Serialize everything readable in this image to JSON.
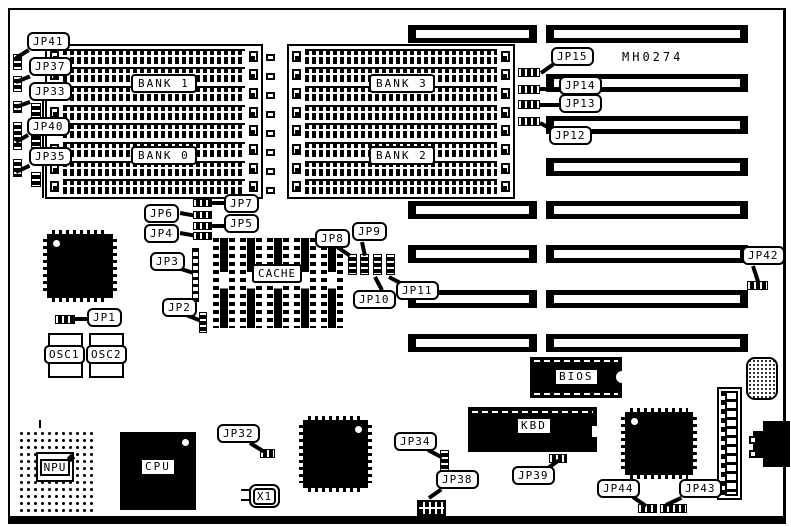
{
  "board": {
    "code": "MH0274"
  },
  "banks": {
    "bank0": "BANK 0",
    "bank1": "BANK 1",
    "bank2": "BANK 2",
    "bank3": "BANK 3"
  },
  "chips": {
    "cache": "CACHE",
    "bios": "BIOS",
    "kbd": "KBD",
    "npu": "NPU",
    "cpu": "CPU",
    "osc1": "OSC1",
    "osc2": "OSC2",
    "x1": "X1"
  },
  "jumpers": {
    "jp1": "JP1",
    "jp2": "JP2",
    "jp3": "JP3",
    "jp4": "JP4",
    "jp5": "JP5",
    "jp6": "JP6",
    "jp7": "JP7",
    "jp8": "JP8",
    "jp9": "JP9",
    "jp10": "JP10",
    "jp11": "JP11",
    "jp12": "JP12",
    "jp13": "JP13",
    "jp14": "JP14",
    "jp15": "JP15",
    "jp32": "JP32",
    "jp33": "JP33",
    "jp34": "JP34",
    "jp35": "JP35",
    "jp37": "JP37",
    "jp38": "JP38",
    "jp39": "JP39",
    "jp40": "JP40",
    "jp41": "JP41",
    "jp42": "JP42",
    "jp43": "JP43",
    "jp44": "JP44"
  }
}
